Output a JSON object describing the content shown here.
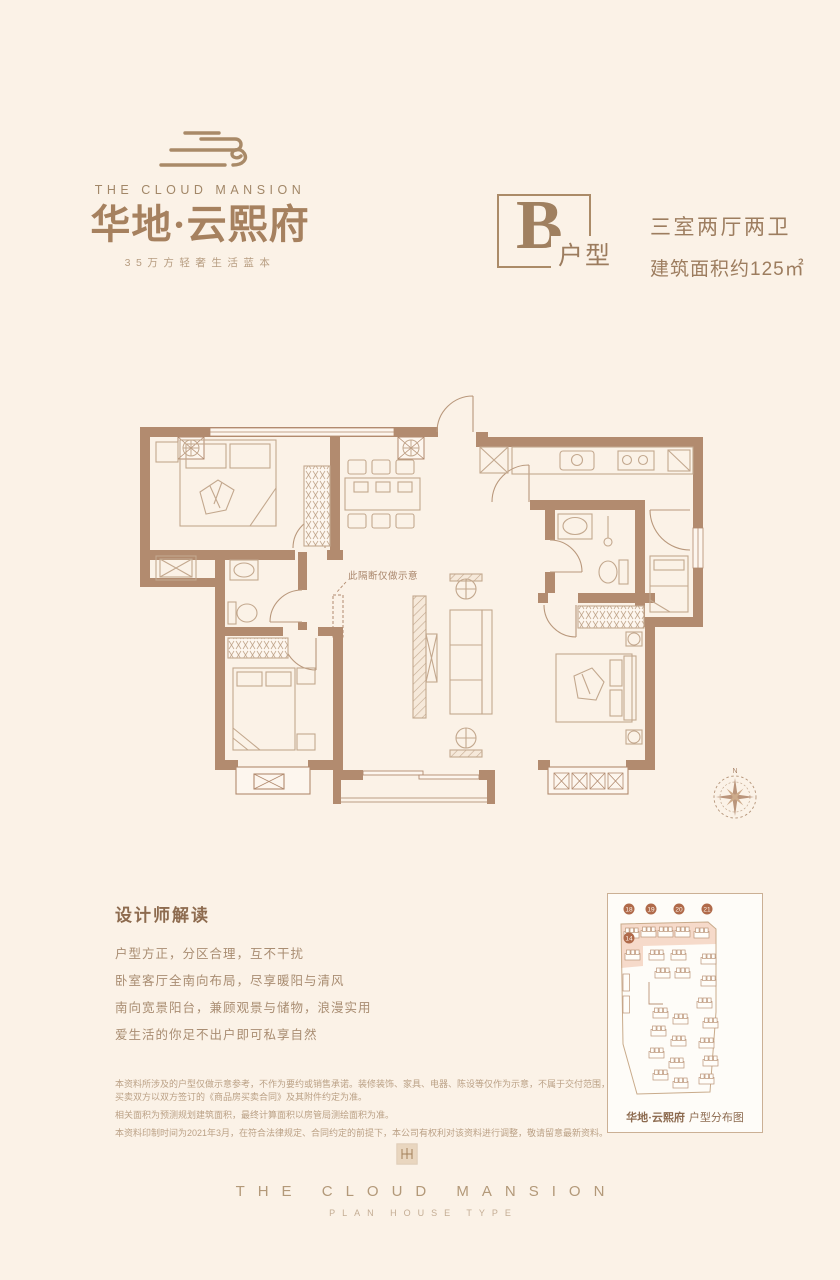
{
  "brand": {
    "name_en": "THE CLOUD MANSION",
    "name_cn": "华地·云熙府",
    "tagline": "35万方轻奢生活蓝本"
  },
  "unit": {
    "letter": "B",
    "type_label": "户型",
    "rooms": "三室两厅两卫",
    "area": "建筑面积约125㎡"
  },
  "floor_plan": {
    "partition_note": "此隔断仅做示意",
    "compass_north": "N"
  },
  "designer_notes": {
    "title": "设计师解读",
    "lines": [
      "户型方正，分区合理，互不干扰",
      "卧室客厅全南向布局，尽享暖阳与清风",
      "南向宽景阳台，兼顾观景与储物，浪漫实用",
      "爱生活的你足不出户即可私享自然"
    ]
  },
  "disclaimer": {
    "paragraphs": [
      "本资料所涉及的户型仅做示意参考，不作为要约或销售承诺。装修装饰、家具、电器、陈设等仅作为示意，不属于交付范围，也并非交付标准，买卖双方以双方签订的《商品房买卖合同》及其附件约定为准。",
      "相关面积为预测规划建筑面积，最终计算面积以房管局测绘面积为准。",
      "本资料印制时间为2021年3月，在符合法律规定、合同约定的前提下，本公司有权利对该资料进行调整，敬请留意最新资料。"
    ]
  },
  "site_map": {
    "brand": "华地·云熙府",
    "label": "户型分布图",
    "building_numbers": [
      "18",
      "19",
      "20",
      "21"
    ],
    "highlight_number": "14"
  },
  "footer": {
    "line1": "THE CLOUD MANSION",
    "line2": "PLAN HOUSE TYPE"
  },
  "colors": {
    "background": "#fbf2e7",
    "wall": "#b28b6f",
    "furniture_line": "#c3a88e",
    "text_brown": "#9d7d5f",
    "accent_dark": "#8d6b4f",
    "map_highlight": "#f5d3c2",
    "map_marker": "#b06a4a"
  }
}
